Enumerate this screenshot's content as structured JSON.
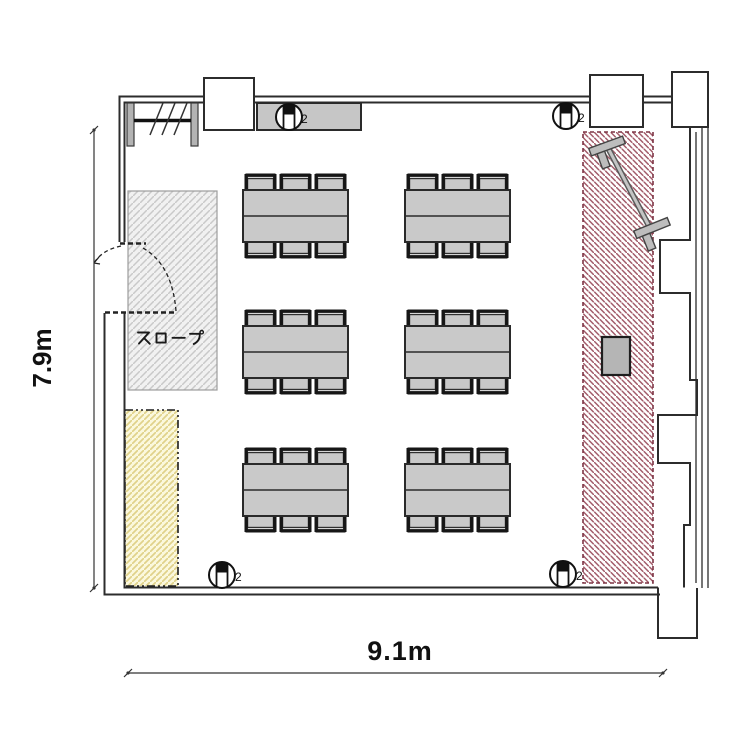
{
  "dimensions": {
    "height": "7.9m",
    "width": "9.1m"
  },
  "labels": {
    "slope": "スロープ"
  },
  "fixtures": [
    {
      "position": "top-left",
      "label": "2"
    },
    {
      "position": "top-right",
      "label": "2"
    },
    {
      "position": "bottom-left",
      "label": "2"
    },
    {
      "position": "bottom-right",
      "label": "2"
    }
  ],
  "colors": {
    "wall_line": "#2c2c2c",
    "furniture_gray": "#c9c9c9",
    "red_hatch_line": "#a25b69",
    "red_hatch_border": "#7d3344",
    "gray_hatch_line": "#c9c9c9",
    "gray_hatch_bg": "#f1f1f1",
    "yellow_hatch_line": "#e0d28a",
    "yellow_hatch_bg": "#fbf8dd"
  }
}
